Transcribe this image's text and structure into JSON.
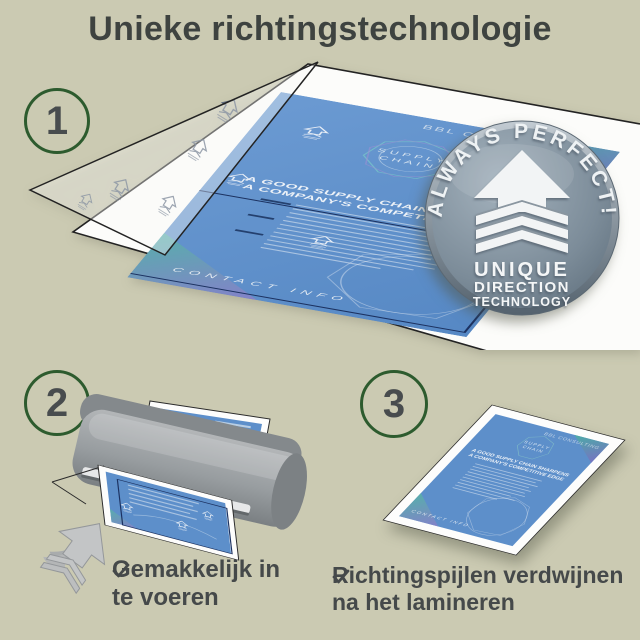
{
  "title": "Unieke richtingstechnologie",
  "steps": {
    "one": {
      "number": "1"
    },
    "two": {
      "number": "2",
      "caption_line1": "Gemakkelijk in",
      "caption_line2": "te voeren"
    },
    "three": {
      "number": "3",
      "caption_line1": "Richtingspijlen verdwijnen",
      "caption_line2": "na het lamineren"
    }
  },
  "badge": {
    "arc_text": "ALWAYS PERFECT!",
    "line1": "UNIQUE",
    "line2": "DIRECTION",
    "line3": "TECHNOLOGY"
  },
  "flyer": {
    "brand": "BBL CONSULTING",
    "emblem_line1": "SUPPLY",
    "emblem_line2": "CHAIN",
    "headline_line1": "A GOOD SUPPLY CHAIN SHARPENS",
    "headline_line2": "A COMPANY'S COMPETITIVE EDGE",
    "footer": "CONTACT INFO"
  },
  "icons": {
    "check": "check-icon",
    "badge_arrow": "up-arrow-with-layers-icon",
    "direction_arrow": "up-arrow-icon",
    "feed_arrow": "up-arrow-with-layers-icon"
  },
  "colors": {
    "background": "#cbcab2",
    "title": "#3e4340",
    "step_circle_border": "#2d5b2e",
    "flyer_blue": "#5d8fca",
    "badge_face": "#8094a1",
    "caption": "#45494a",
    "laminator_gray": "#969a9d"
  }
}
